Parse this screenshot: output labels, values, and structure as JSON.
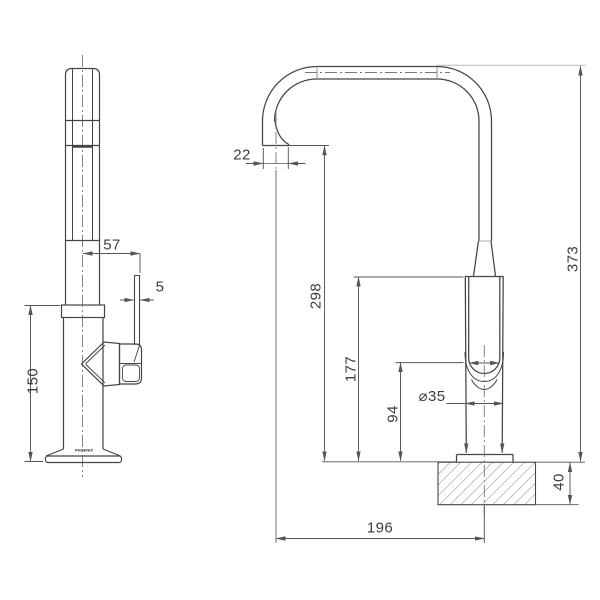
{
  "drawing": {
    "logo": "PHOENIX",
    "dims": {
      "side": {
        "handle_offset": "57",
        "handle_thickness": "5",
        "body_height": "150"
      },
      "front": {
        "spout_tip": "22",
        "outlet_height": "298",
        "body_top_height": "177",
        "handle_bottom_height": "94",
        "body_diameter": "⌀35",
        "overall_height": "373",
        "bench_thickness": "40",
        "spout_reach": "196"
      }
    },
    "colors": {
      "object_line": "#444444",
      "dimension_line": "#555555",
      "centerline": "#777777",
      "light_extension": "#b8b8b8",
      "hatch": "#8a8a8a",
      "background": "#ffffff"
    }
  }
}
